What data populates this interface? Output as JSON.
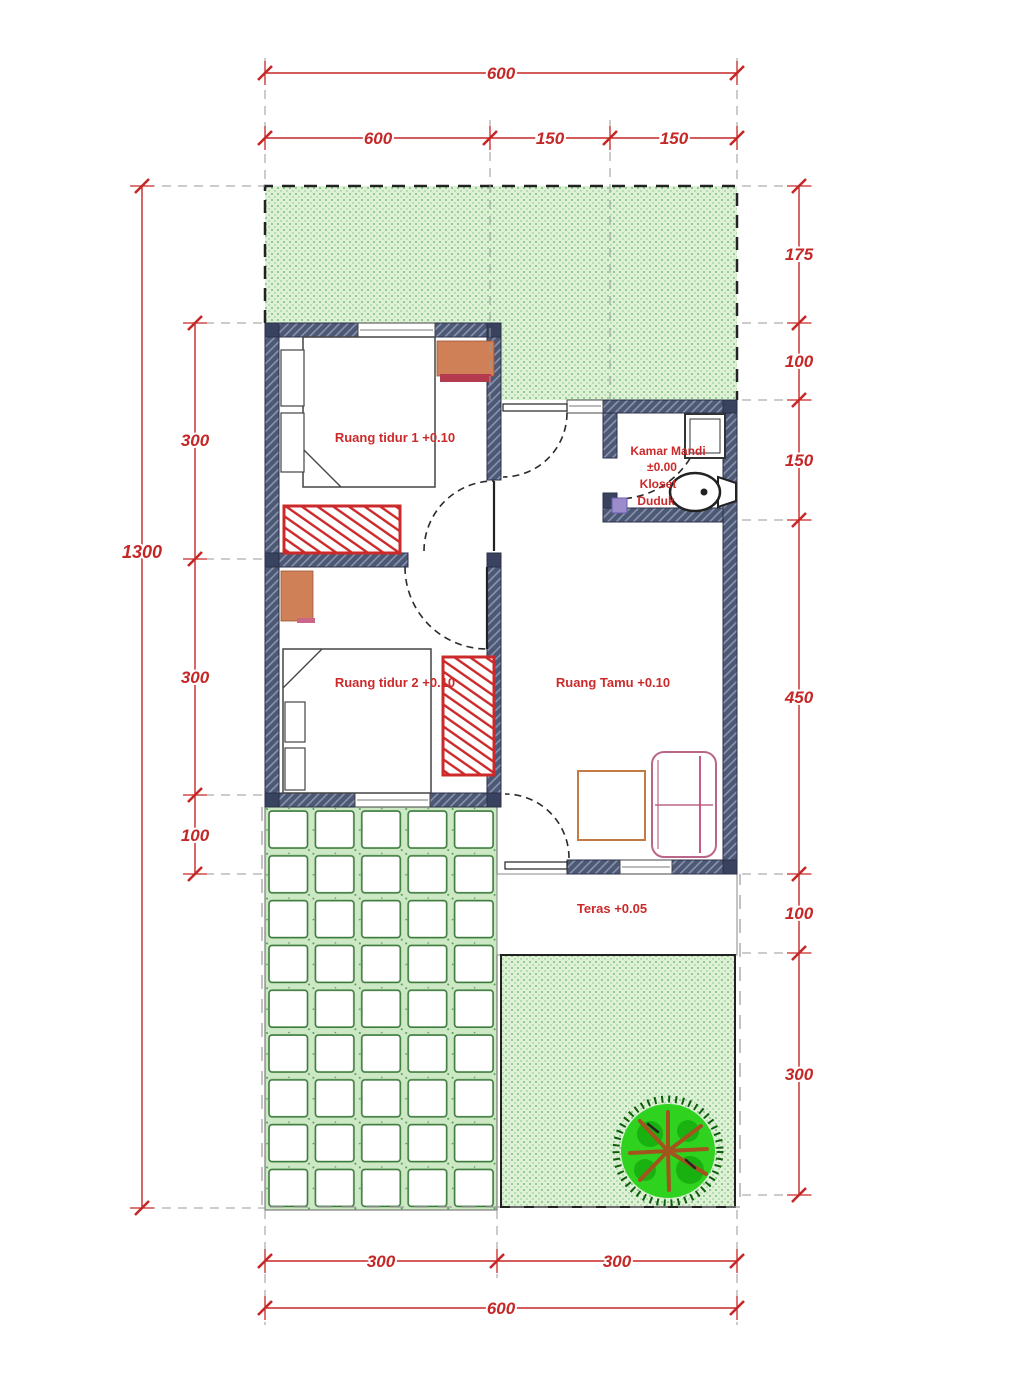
{
  "labels": {
    "bedroom1": "Ruang tidur 1  +0.10",
    "bedroom2": "Ruang tidur 2  +0.10",
    "living_room": "Ruang Tamu  +0.10",
    "bathroom_name": "Kamar Mandi",
    "bathroom_level": "±0.00",
    "bathroom_fixture_line1": "Kloset",
    "bathroom_fixture_line2": "Duduk",
    "terrace": "Teras  +0.05"
  },
  "dimensions": {
    "top_total": "600",
    "top_segments": [
      "600",
      "150",
      "150"
    ],
    "left_total": "1300",
    "left_segments": [
      "300",
      "300",
      "100"
    ],
    "right_segments": [
      "175",
      "100",
      "150",
      "450",
      "100",
      "300"
    ],
    "bottom_segments": [
      "300",
      "300"
    ],
    "bottom_total": "600"
  },
  "colors": {
    "dimension_red": "#c52727",
    "wall_fill": "#4d5872",
    "grass_green_light": "#def1d7",
    "grass_green_dot": "#5cb35c",
    "tree_canopy_green": "#2fd31f",
    "tree_branch_brown": "#a3541d",
    "furniture_orange": "#cf8057",
    "sofa_outline_pink": "#bb6688",
    "wardrobe_hatch_red": "#cc2a2a",
    "floor_drain_purple": "#9b8ccc"
  }
}
